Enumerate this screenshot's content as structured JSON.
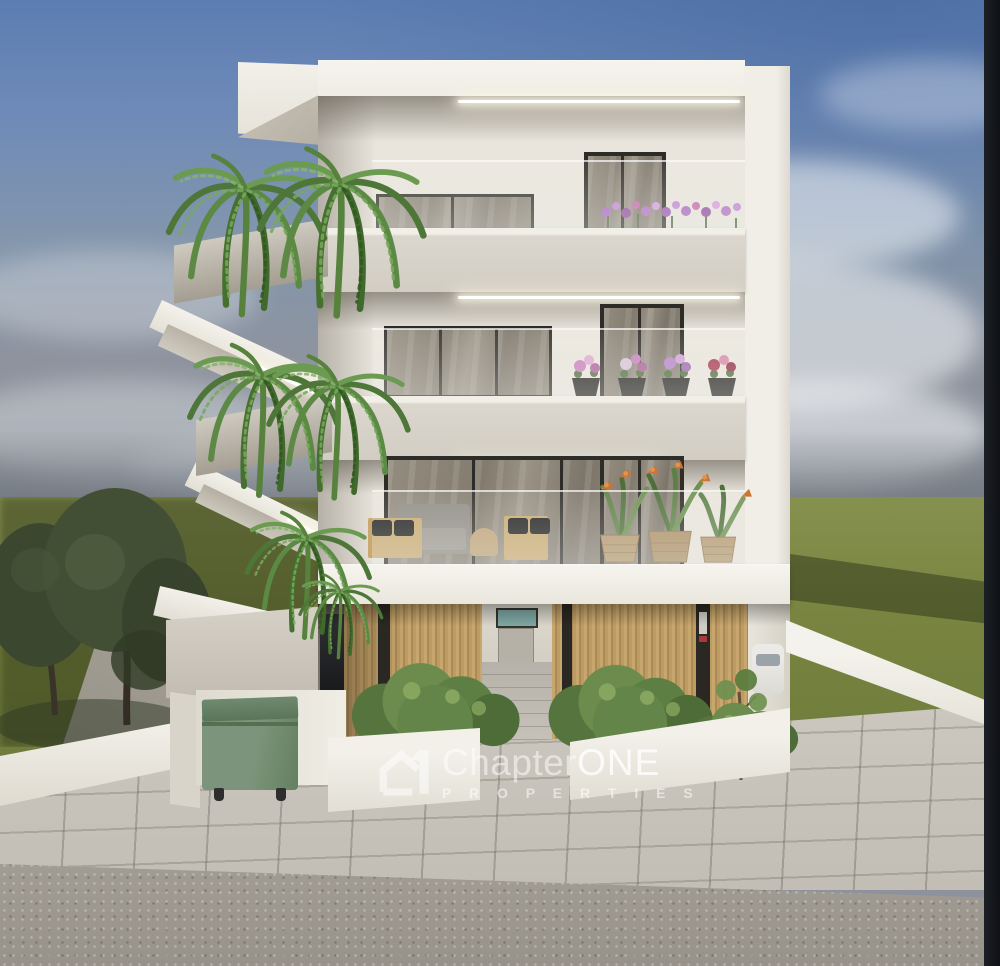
{
  "meta": {
    "image_type": "3D architectural rendering",
    "scene_summary": "Front elevation of a modern three-storey white apartment building at dusk-lit daytime, with cantilevered balconies, hanging ferns, timber-louvre carport, landscaped planters, green wheelie bin, paved sidewalk and road, olive trees left, open green field behind"
  },
  "watermark": {
    "logo_icon": "house-number-one-logo",
    "brand": "Chapter",
    "brand_accent": "ONE",
    "tagline": "P R O P E R T I E S"
  },
  "scene": {
    "building": {
      "storeys": 3,
      "facade_color": "#efede6",
      "slab_color": "#d9d5cb",
      "timber_louvre_color": "#bd9c63",
      "glazing_color": "#867e71",
      "features": [
        "LED cove lighting under balcony slabs",
        "frameless glass balustrades",
        "hanging boston ferns on left balconies",
        "purple flower boxes on top-right balcony",
        "four flower pots on middle-right balcony ledge",
        "wicker planters with bird-of-paradise on first-floor balcony",
        "outdoor lounge furniture on first-floor balcony",
        "ground-floor carport with parked cars behind timber slats"
      ]
    },
    "environment": {
      "sky_top_color": "#5c7db1",
      "sky_horizon_color": "#848a92",
      "field_color": "#78843f",
      "sidewalk_color": "#c6c2b9",
      "road_color": "#9d988f",
      "dumpster_color": "#7a937a",
      "right_edge_bar_color": "#14171b",
      "elements": [
        "hazy blue sky with soft clouds",
        "olive trees on the left",
        "white perimeter walls and planters with shrubs",
        "green wheelie dumpster in white enclosure",
        "white car parked at right driveway",
        "young sapling tree at right planter"
      ]
    }
  }
}
